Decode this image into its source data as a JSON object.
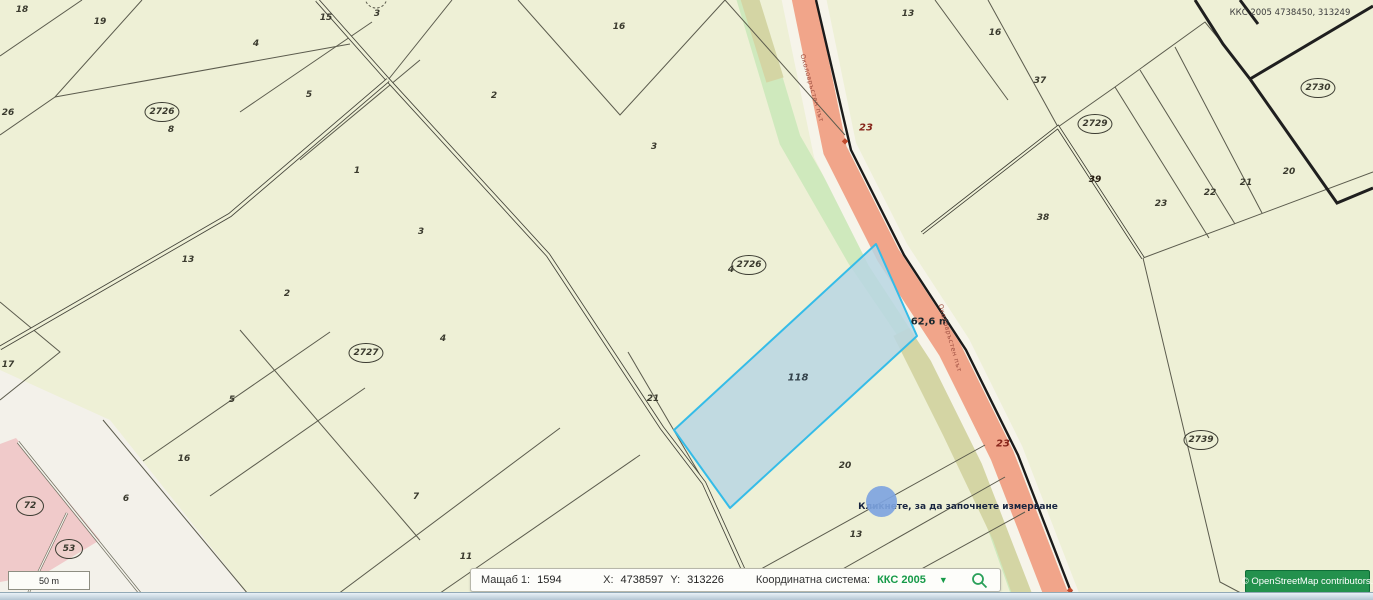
{
  "map": {
    "background": "#eef0d6",
    "colors": {
      "parcel_line": "#5b5b4d",
      "thick_line": "#1f1f1f",
      "road_salmon": "#f1a58a",
      "road_shoulder": "#f6f4ea",
      "green_strip": "#cfe9bd",
      "olive_strip": "#d4d5a4",
      "selected_fill": "#b9d6e3",
      "selected_stroke": "#35bce8",
      "pink_zone": "#f0caca",
      "white_zone": "#f3f1ea",
      "measure_dot": "#7ea4e0",
      "accent_green": "#169a48"
    },
    "selected_parcel": {
      "number": "118"
    },
    "labels": [
      {
        "text": "18",
        "x": 22,
        "y": 10,
        "type": "parcel"
      },
      {
        "text": "19",
        "x": 100,
        "y": 22,
        "type": "parcel"
      },
      {
        "text": "15",
        "x": 326,
        "y": 18,
        "type": "parcel"
      },
      {
        "text": "3",
        "x": 377,
        "y": 14,
        "type": "parcel"
      },
      {
        "text": "26",
        "x": 8,
        "y": 113,
        "type": "parcel"
      },
      {
        "text": "2726",
        "x": 162,
        "y": 112,
        "type": "circled"
      },
      {
        "text": "8",
        "x": 171,
        "y": 130,
        "type": "parcel"
      },
      {
        "text": "4",
        "x": 256,
        "y": 44,
        "type": "parcel"
      },
      {
        "text": "5",
        "x": 309,
        "y": 95,
        "type": "parcel"
      },
      {
        "text": "1",
        "x": 357,
        "y": 171,
        "type": "parcel"
      },
      {
        "text": "2",
        "x": 494,
        "y": 96,
        "type": "parcel"
      },
      {
        "text": "16",
        "x": 619,
        "y": 27,
        "type": "parcel"
      },
      {
        "text": "3",
        "x": 654,
        "y": 147,
        "type": "parcel"
      },
      {
        "text": "13",
        "x": 188,
        "y": 260,
        "type": "parcel"
      },
      {
        "text": "2",
        "x": 287,
        "y": 294,
        "type": "parcel"
      },
      {
        "text": "3",
        "x": 421,
        "y": 232,
        "type": "parcel"
      },
      {
        "text": "2727",
        "x": 366,
        "y": 353,
        "type": "circled"
      },
      {
        "text": "4",
        "x": 443,
        "y": 339,
        "type": "parcel"
      },
      {
        "text": "5",
        "x": 232,
        "y": 400,
        "type": "parcel"
      },
      {
        "text": "17",
        "x": 8,
        "y": 365,
        "type": "parcel"
      },
      {
        "text": "16",
        "x": 184,
        "y": 459,
        "type": "parcel"
      },
      {
        "text": "6",
        "x": 126,
        "y": 499,
        "type": "parcel"
      },
      {
        "text": "72",
        "x": 30,
        "y": 506,
        "type": "circled"
      },
      {
        "text": "53",
        "x": 69,
        "y": 549,
        "type": "circled"
      },
      {
        "text": "7",
        "x": 416,
        "y": 497,
        "type": "parcel"
      },
      {
        "text": "11",
        "x": 466,
        "y": 557,
        "type": "parcel"
      },
      {
        "text": "12",
        "x": 509,
        "y": 594,
        "type": "parcel"
      },
      {
        "text": "4",
        "x": 731,
        "y": 270,
        "type": "parcel"
      },
      {
        "text": "2726",
        "x": 749,
        "y": 265,
        "type": "circled"
      },
      {
        "text": "21",
        "x": 653,
        "y": 399,
        "type": "parcel"
      },
      {
        "text": "118",
        "x": 798,
        "y": 378,
        "type": "strong"
      },
      {
        "text": "62,6 m",
        "x": 930,
        "y": 322,
        "type": "measure"
      },
      {
        "text": "20",
        "x": 845,
        "y": 466,
        "type": "parcel"
      },
      {
        "text": "13",
        "x": 856,
        "y": 535,
        "type": "parcel"
      },
      {
        "text": "116",
        "x": 876,
        "y": 573,
        "type": "parcel"
      },
      {
        "text": "23",
        "x": 866,
        "y": 128,
        "type": "roadnum-red"
      },
      {
        "text": "23",
        "x": 1003,
        "y": 444,
        "type": "roadnum-red"
      },
      {
        "text": "13",
        "x": 908,
        "y": 14,
        "type": "parcel"
      },
      {
        "text": "16",
        "x": 995,
        "y": 33,
        "type": "parcel"
      },
      {
        "text": "37",
        "x": 1040,
        "y": 81,
        "type": "parcel"
      },
      {
        "text": "38",
        "x": 1043,
        "y": 218,
        "type": "parcel"
      },
      {
        "text": "39",
        "x": 1095,
        "y": 180,
        "type": "roadnum-dark"
      },
      {
        "text": "2729",
        "x": 1095,
        "y": 124,
        "type": "circled"
      },
      {
        "text": "23",
        "x": 1161,
        "y": 204,
        "type": "parcel"
      },
      {
        "text": "22",
        "x": 1210,
        "y": 193,
        "type": "parcel"
      },
      {
        "text": "21",
        "x": 1246,
        "y": 183,
        "type": "parcel"
      },
      {
        "text": "20",
        "x": 1289,
        "y": 172,
        "type": "parcel"
      },
      {
        "text": "2730",
        "x": 1318,
        "y": 88,
        "type": "circled"
      },
      {
        "text": "2739",
        "x": 1201,
        "y": 440,
        "type": "circled"
      },
      {
        "text": "ККС 2005 4738450, 313249",
        "x": 1290,
        "y": 13,
        "type": "coords"
      },
      {
        "text": "Кликнете, за да започнете измерване",
        "x": 958,
        "y": 507,
        "type": "hint"
      },
      {
        "text": "Околовръстен път",
        "x": 812,
        "y": 88,
        "type": "roadname",
        "rot": 74
      },
      {
        "text": "Околовръстен път",
        "x": 950,
        "y": 338,
        "type": "roadname",
        "rot": 74
      }
    ]
  },
  "status_bar": {
    "scale_label": "Мащаб 1:",
    "scale_value": "1594",
    "x_label": "X:",
    "x_value": "4738597",
    "y_label": "Y:",
    "y_value": "313226",
    "crs_label": "Координатна система:",
    "crs_value": "ККС 2005",
    "crs_arrow": "▼"
  },
  "scale_bar": {
    "label": "50 m"
  },
  "attribution": {
    "text": "© OpenStreetMap  contributors."
  }
}
